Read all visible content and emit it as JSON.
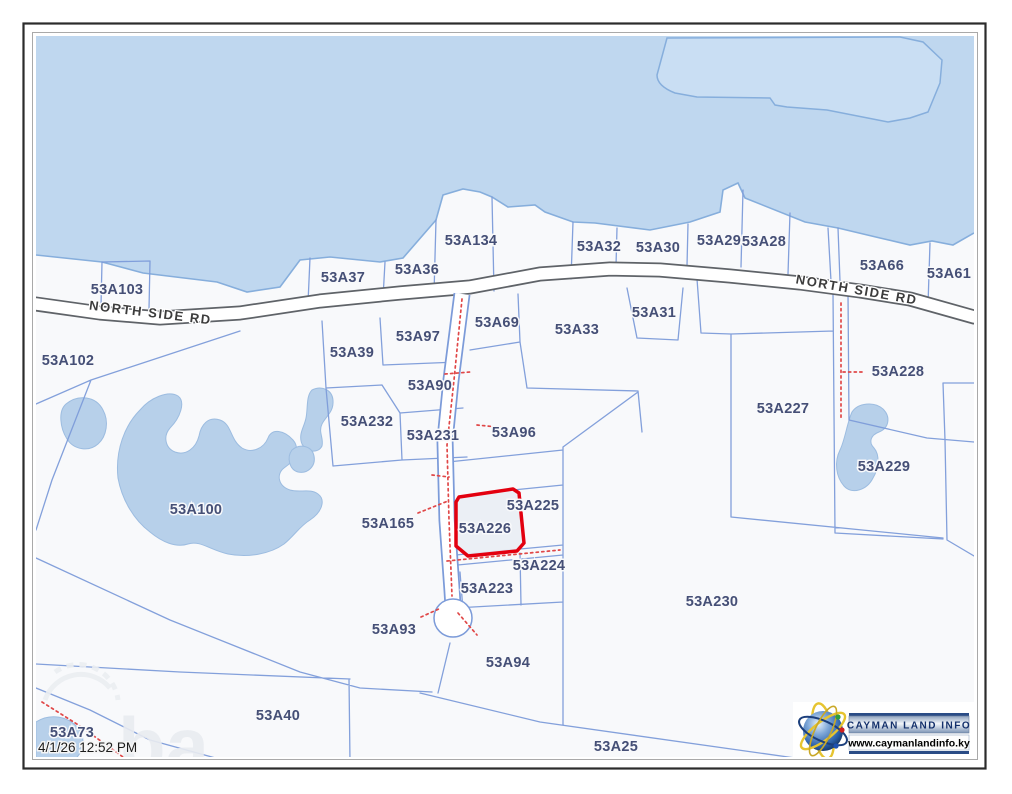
{
  "frame": {
    "timestamp": "4/1/26 12:52 PM"
  },
  "road_labels": [
    {
      "text": "NORTH SIDE RD",
      "x": 150,
      "y": 317,
      "rotate": 7
    },
    {
      "text": "NORTH SIDE RD",
      "x": 856,
      "y": 294,
      "rotate": 10
    }
  ],
  "parcels": [
    {
      "id": "53A103",
      "x": 117,
      "y": 289
    },
    {
      "id": "53A102",
      "x": 68,
      "y": 360
    },
    {
      "id": "53A37",
      "x": 343,
      "y": 277
    },
    {
      "id": "53A36",
      "x": 417,
      "y": 269
    },
    {
      "id": "53A134",
      "x": 471,
      "y": 240
    },
    {
      "id": "53A32",
      "x": 599,
      "y": 246
    },
    {
      "id": "53A30",
      "x": 658,
      "y": 247
    },
    {
      "id": "53A29",
      "x": 719,
      "y": 240
    },
    {
      "id": "53A28",
      "x": 764,
      "y": 241
    },
    {
      "id": "53A66",
      "x": 882,
      "y": 265
    },
    {
      "id": "53A61",
      "x": 949,
      "y": 273
    },
    {
      "id": "53A97",
      "x": 418,
      "y": 336
    },
    {
      "id": "53A69",
      "x": 497,
      "y": 322
    },
    {
      "id": "53A33",
      "x": 577,
      "y": 329
    },
    {
      "id": "53A31",
      "x": 654,
      "y": 312
    },
    {
      "id": "53A39",
      "x": 352,
      "y": 352
    },
    {
      "id": "53A90",
      "x": 430,
      "y": 385
    },
    {
      "id": "53A232",
      "x": 367,
      "y": 421
    },
    {
      "id": "53A231",
      "x": 433,
      "y": 435
    },
    {
      "id": "53A96",
      "x": 514,
      "y": 432
    },
    {
      "id": "53A227",
      "x": 783,
      "y": 408
    },
    {
      "id": "53A228",
      "x": 898,
      "y": 371
    },
    {
      "id": "53A229",
      "x": 884,
      "y": 466
    },
    {
      "id": "53A100",
      "x": 196,
      "y": 509
    },
    {
      "id": "53A165",
      "x": 388,
      "y": 523
    },
    {
      "id": "53A226",
      "x": 485,
      "y": 528
    },
    {
      "id": "53A225",
      "x": 533,
      "y": 505
    },
    {
      "id": "53A224",
      "x": 539,
      "y": 565
    },
    {
      "id": "53A223",
      "x": 487,
      "y": 588
    },
    {
      "id": "53A93",
      "x": 394,
      "y": 629
    },
    {
      "id": "53A94",
      "x": 508,
      "y": 662
    },
    {
      "id": "53A230",
      "x": 712,
      "y": 601
    },
    {
      "id": "53A40",
      "x": 278,
      "y": 715
    },
    {
      "id": "53A73",
      "x": 72,
      "y": 732
    },
    {
      "id": "53A25",
      "x": 616,
      "y": 746
    }
  ],
  "highlight": {
    "parcel_id": "53A226",
    "outline_color": "#E3000F"
  },
  "watermark": {
    "visible_text": "ba"
  },
  "branding": {
    "title": "CAYMAN LAND INFO",
    "website": "www.caymanlandinfo.ky"
  },
  "colors": {
    "water": "#BFD7EF",
    "land": "#F8F9FB",
    "parcel_line": "#7C9BD9",
    "label_text": "#454F76",
    "highlight_red": "#E3000F",
    "dotted_red": "#E04848"
  }
}
